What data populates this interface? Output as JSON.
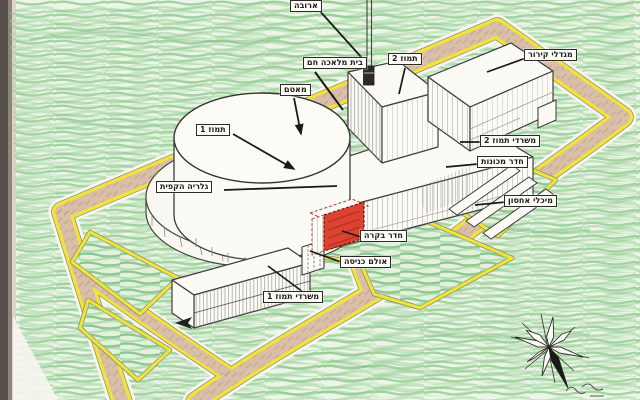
{
  "drawing": {
    "description": "hand-drawn isometric site diagram of the Tammuz (Osirak) reactor compound",
    "labels": {
      "chimney": "ארובה",
      "hot_workshop": "בית מלאכה חם",
      "tammuz_2": "תמוז 2",
      "cooling_towers": "מגדלי קירור",
      "dome_top": "מאטם",
      "tammuz_1": "תמוז 1",
      "perimeter_gallery": "גלריה הקפית",
      "tammuz_2_offices": "משרדי תמוז 2",
      "machine_room": "חדר מכונות",
      "storage_tanks": "מיכלי אחסון",
      "control_room": "חדר בקרה",
      "entrance_hall": "אולם כניסה",
      "tammuz_1_offices": "משרדי תמוז 1"
    },
    "colors": {
      "grass_green": "#84c584",
      "road_tan": "#d9bfa8",
      "road_edge_yellow": "#f2e437",
      "building_white": "#fbfaf5",
      "highlight_red": "#dc4331",
      "ink_outline": "#3c3c3c",
      "paper": "#f6f5ef"
    }
  }
}
